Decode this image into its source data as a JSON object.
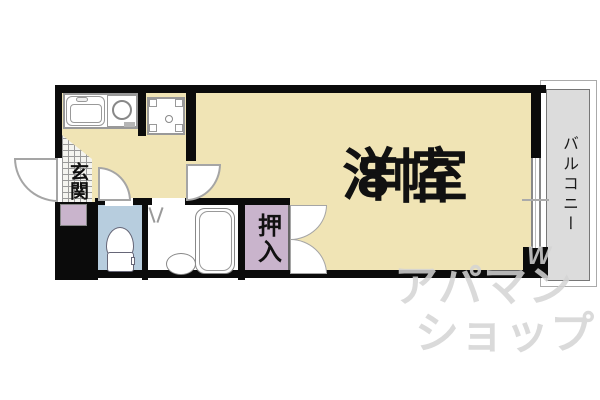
{
  "floorplan": {
    "main_room": {
      "name": "洋室",
      "size": "8帖"
    },
    "balcony_label": "バルコニー",
    "entrance_label": "玄関",
    "closet_label": "押入",
    "watermark": {
      "line1": "アパマン",
      "line2": "ショップ",
      "mark": "W"
    },
    "colors": {
      "floor_beige": "#f0e4b5",
      "wall_black": "#0b0b0b",
      "balcony_gray": "#dcdcdc",
      "closet_purple": "#c9b4cc",
      "toilet_blue": "#b7cdde",
      "watermark_gray": "#d4d4d4"
    }
  }
}
